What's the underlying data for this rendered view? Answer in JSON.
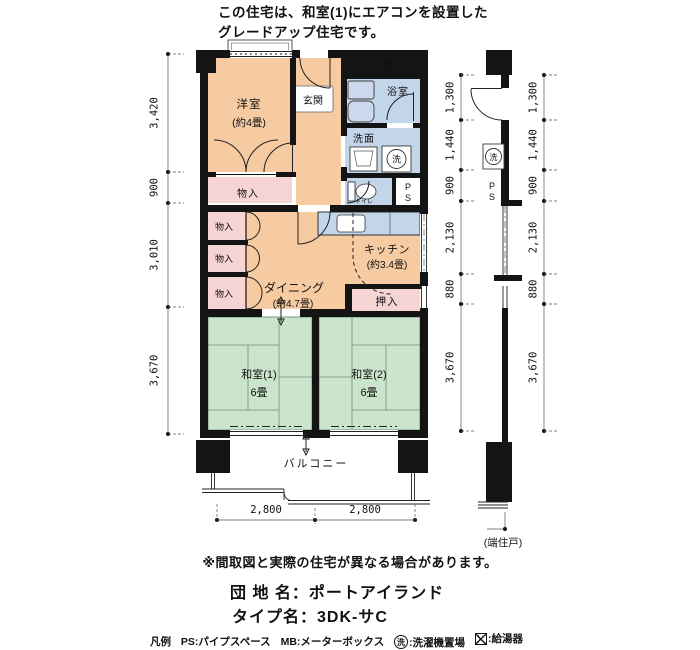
{
  "header": {
    "line1": "この住宅は、和室(1)にエアコンを設置した",
    "line2": "グレードアップ住宅です。"
  },
  "plan": {
    "rooms": {
      "western_room": {
        "name": "洋室",
        "size": "(約4畳)"
      },
      "entrance": {
        "name": "玄関"
      },
      "bathroom": {
        "name": "浴室"
      },
      "washroom": {
        "name": "洗面"
      },
      "toilet": {
        "name": "トイレ"
      },
      "kitchen": {
        "name": "キッチン",
        "size": "(約3.4畳)"
      },
      "dining": {
        "name": "ダイニング",
        "size": "(約4.7畳)"
      },
      "japanese_room_1": {
        "name": "和室(1)",
        "size": "6畳"
      },
      "japanese_room_2": {
        "name": "和室(2)",
        "size": "6畳"
      },
      "closet_oshiire": {
        "name": "押入"
      },
      "storage": {
        "name": "物入"
      },
      "balcony": {
        "name": "バルコニー"
      }
    },
    "symbols": {
      "meter_box": "MB",
      "pipe_space_p": "P",
      "pipe_space_s": "S",
      "laundry": "洗"
    },
    "dimensions": {
      "left": [
        "3,420",
        "900",
        "3,010",
        "3,670"
      ],
      "right": [
        "1,300",
        "1,440",
        "900",
        "2,130",
        "880",
        "3,670"
      ],
      "bottom": [
        "2,800",
        "2,800"
      ],
      "end_unit": "(端住戸)"
    }
  },
  "footer": {
    "disclaimer": "※間取図と実際の住宅が異なる場合があります。",
    "estate_label": "団 地 名：",
    "estate_name": "ポートアイランド",
    "type_label": "タイプ名：",
    "type_name": "3DK-サC",
    "legend": {
      "title": "凡例",
      "ps": "PS:パイプスペース",
      "mb": "MB:メーターボックス",
      "laundry_symbol": "洗",
      "laundry_desc": ":洗濯機置場",
      "heater_desc": ":給湯器"
    }
  },
  "colors": {
    "room_peach": "#F6CBA1",
    "room_pink": "#F6D4D4",
    "room_blue": "#C2D5E9",
    "room_green": "#CBE5CD",
    "wall": "#141414"
  }
}
